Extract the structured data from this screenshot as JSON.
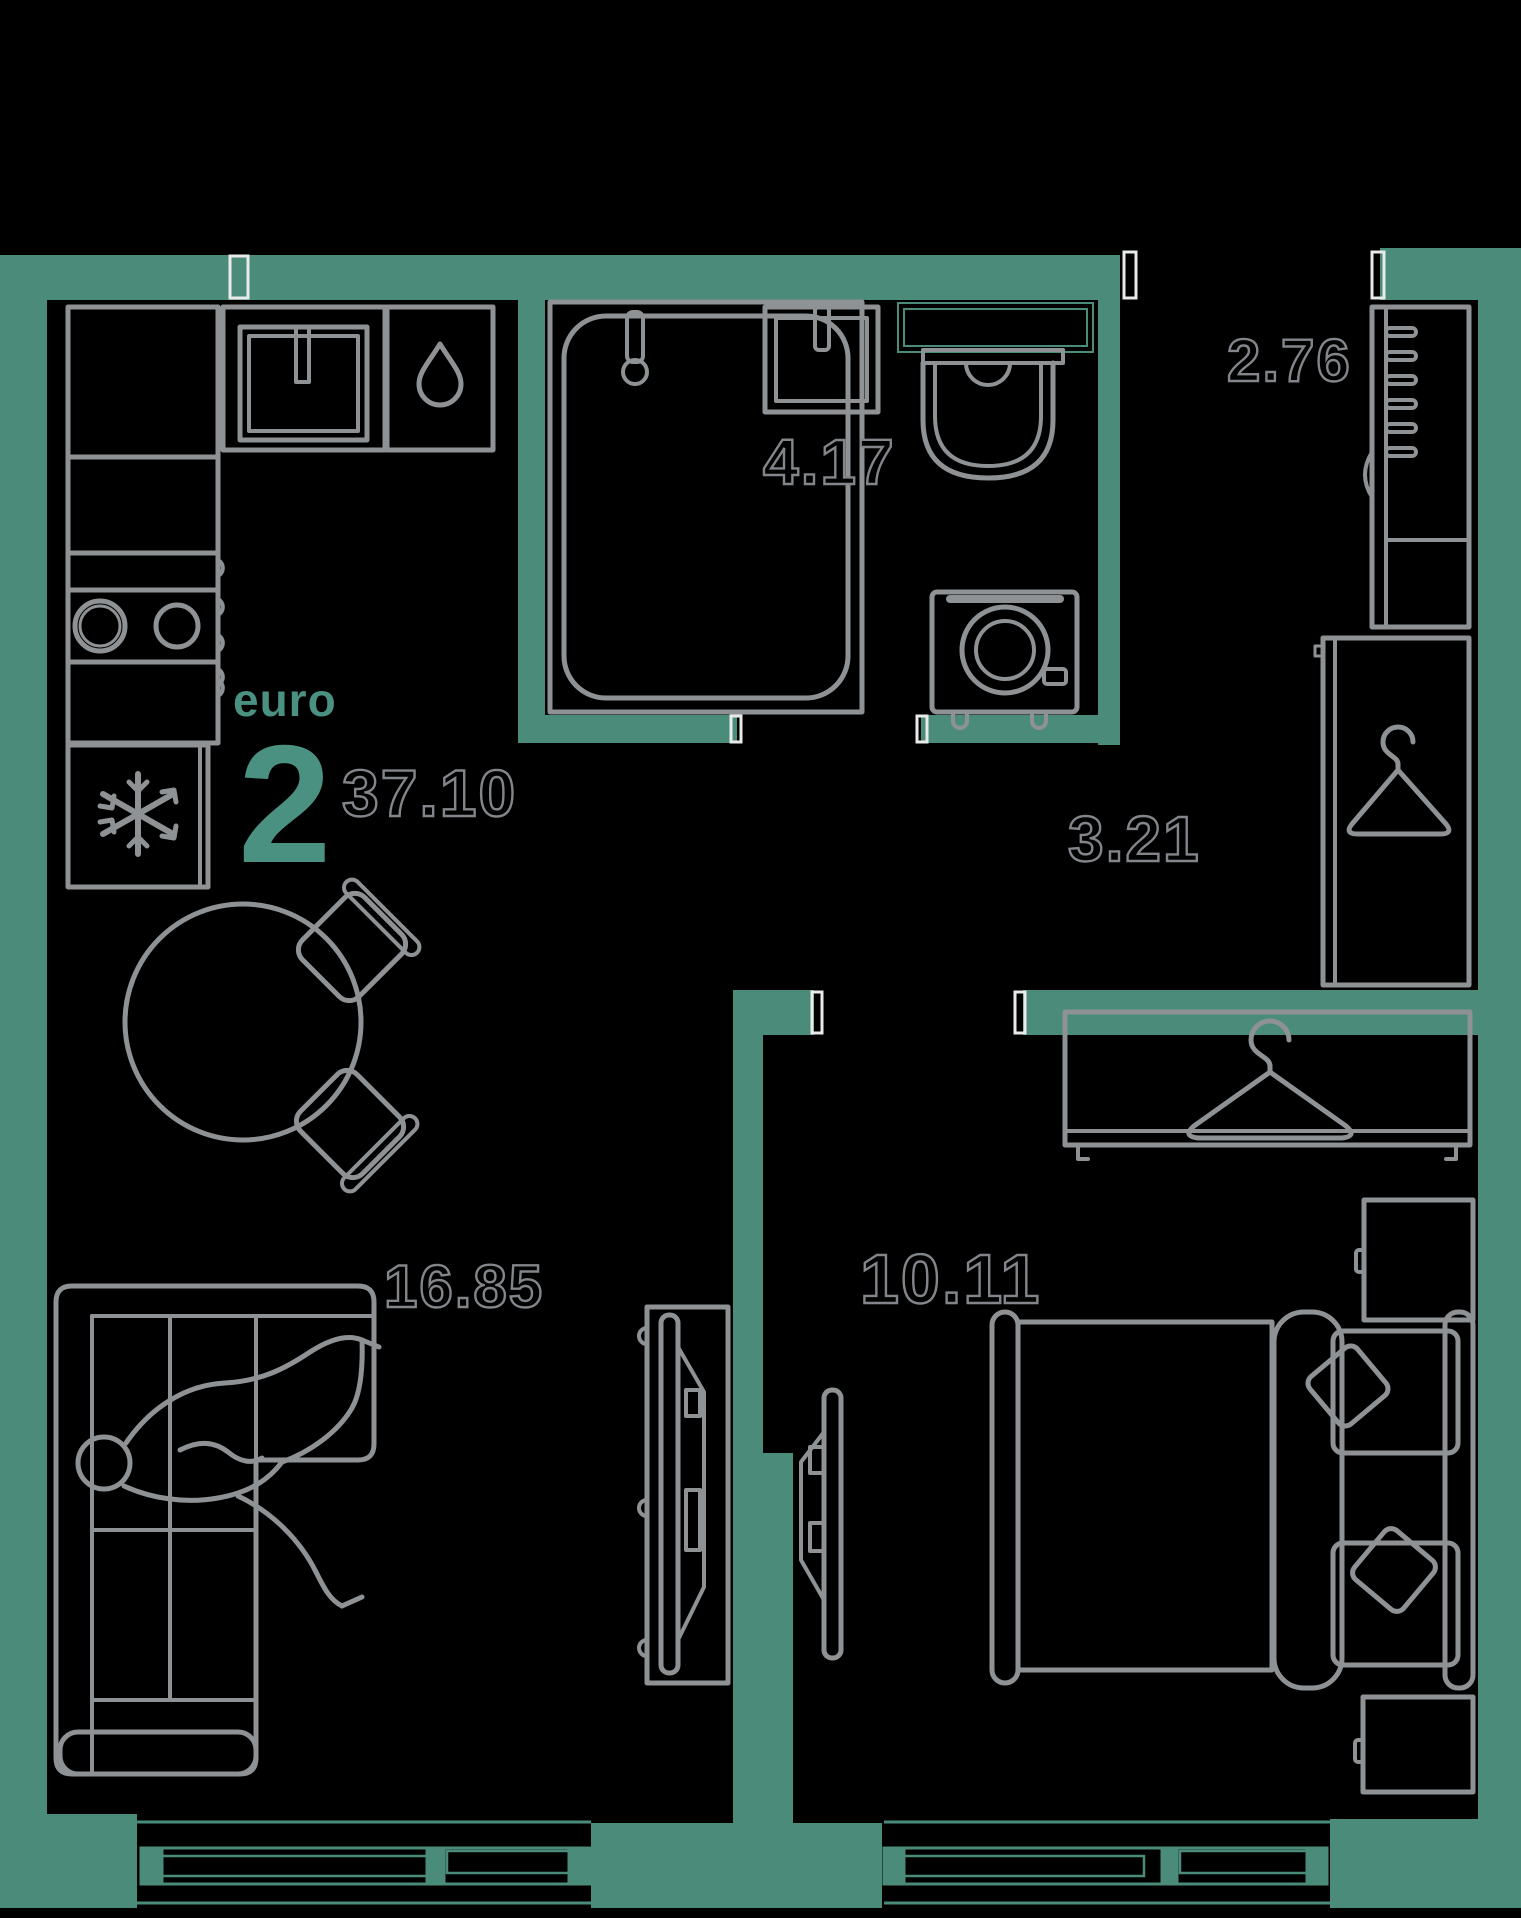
{
  "plan": {
    "unit_type_label": "euro",
    "unit_rooms_count": "2",
    "total_area": "37.10",
    "rooms": [
      {
        "key": "bathroom",
        "area": "4.17"
      },
      {
        "key": "entry-hall",
        "area": "2.76"
      },
      {
        "key": "corridor",
        "area": "3.21"
      },
      {
        "key": "kitchen-living-room",
        "area": "16.85"
      },
      {
        "key": "bedroom",
        "area": "10.11"
      }
    ],
    "colors": {
      "background": "#000000",
      "wall": "#4a8b79",
      "accent_text": "#4b9181",
      "furniture_line": "#8f9295",
      "area_label_outline": "#82858a"
    },
    "icons": [
      "water-drop-icon",
      "snowflake-icon",
      "hanger-icon",
      "person-figure"
    ]
  }
}
